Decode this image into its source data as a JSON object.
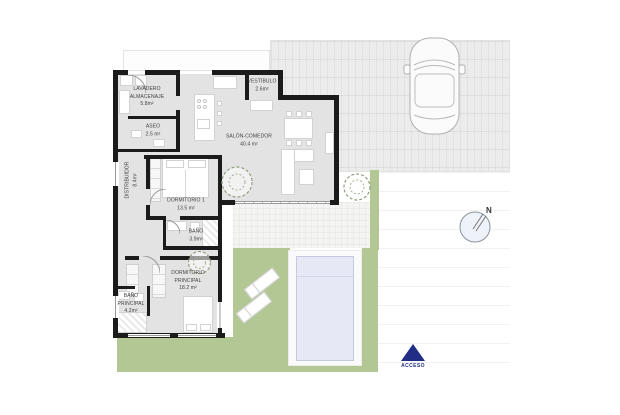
{
  "rooms": [
    {
      "name": "LAVADERO\nALMACENAJE",
      "area": "5.8m²"
    },
    {
      "name": "ASEO",
      "area": "2.5 m²"
    },
    {
      "name": "DISTRIBUIDOR",
      "area": "8.4m²"
    },
    {
      "name": "VESTÍBULO",
      "area": "2.6m²"
    },
    {
      "name": "SALÓN-COMEDOR",
      "area": "40.4 m²"
    },
    {
      "name": "DORMITORIO 1",
      "area": "13.5 m²"
    },
    {
      "name": "BAÑO",
      "area": "3.9m²"
    },
    {
      "name": "DORMITORIO\nPRINCIPAL",
      "area": "18.2 m²"
    },
    {
      "name": "BAÑO\nPRINCIPAL",
      "area": "4.2m²"
    }
  ],
  "compass": {
    "north_label": "N"
  },
  "access": {
    "label": "ACCESO"
  },
  "colors": {
    "wall": "#1b1b1b",
    "interior": "#e3e3e3",
    "lawn": "#b3c795",
    "pool": "#e6e9f5",
    "driveway": "#ececec",
    "access_navy": "#202e86"
  }
}
